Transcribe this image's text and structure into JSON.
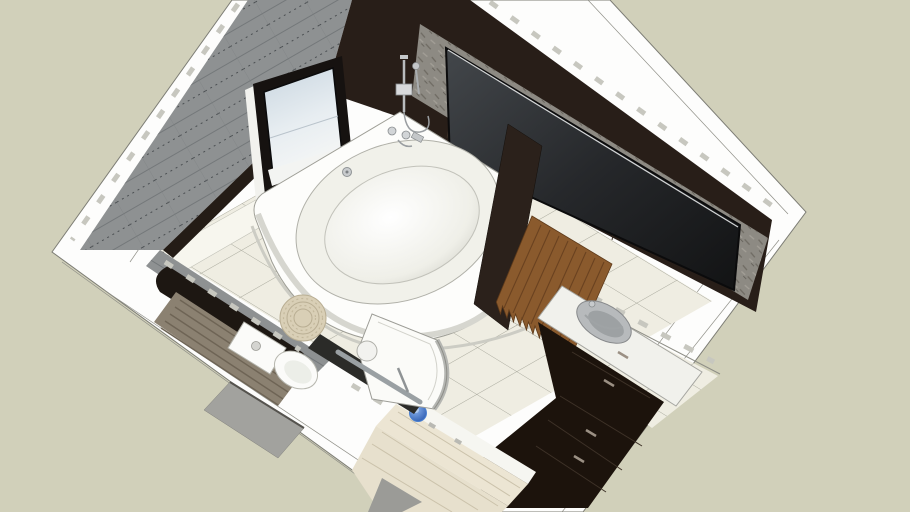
{
  "viewport": {
    "description": "Axonometric 3D model preview of a modern bathroom seen from above, rotated about 40 degrees, on a two-tone studio background",
    "view": "top-down orbit view"
  },
  "objects": {
    "bathtub": "corner round bathtub with deck-mounted chrome faucet and drain",
    "wall_mixer": "chrome shower mixer on corner wall",
    "mirror": "large dark wall mirror in stone-texture band",
    "window": "dark-framed window with light glass on gray tiled wall",
    "towel": "brown shaggy fringed towel hanging on half wall",
    "vanity": "white counter with inset gray oval sink and chrome faucet",
    "vanity_cabinet": "dark brown drawer cabinet under counter",
    "tall_cabinet": "glossy dark floor cabinet at bottom right",
    "wood_cabinet": "light wood bench cabinet at bottom",
    "shower": "quarter-round shower tray with curved glass and chrome rail",
    "toilet": "white toilet with round flush button",
    "pouf": "round wicker pouf with spiral texture",
    "bucket": "small blue bucket on wood cabinet",
    "bench": "dark bench with striped taupe slat top along lower-left wall",
    "door": "gray door threshold opening in lower-left wall"
  },
  "colors": {
    "background": "#d1d0ba",
    "wall_top_white": "#fdfdfc",
    "seam_gray": "#8f8f87",
    "tick_gray": "#c7c7bf",
    "floor_tile": "#efede2",
    "floor_grout": "#a6a69a",
    "floor_border": "#f7f6ee",
    "wall_tile_gray": "#8e9192",
    "wall_dark_brown": "#281e18",
    "stone_band": "#8d8a83",
    "mirror_glass": "#222427",
    "window_frame": "#161210",
    "window_glass": "#dce4ea",
    "fixture_chrome": "#b9bcbe",
    "tub_white": "#fdfdfb",
    "tub_rim": "#f1f1ea",
    "towel_brown": "#8a5a2d",
    "vanity_counter": "#f1f1ec",
    "sink_gray": "#b7babc",
    "cabinet_dark": "#1c130c",
    "wood_light": "#e7e0cd",
    "bench_dark": "#1d1712",
    "mat_taupe": "#8b8171",
    "shower_tray": "#fbfbf8",
    "shower_rim": "#b5b6b2",
    "bucket_blue": "#4a7fd0",
    "pouf_beige": "#d9cfb6",
    "toilet_white": "#fbfbf9",
    "threshold_gray": "#a2a29e"
  }
}
